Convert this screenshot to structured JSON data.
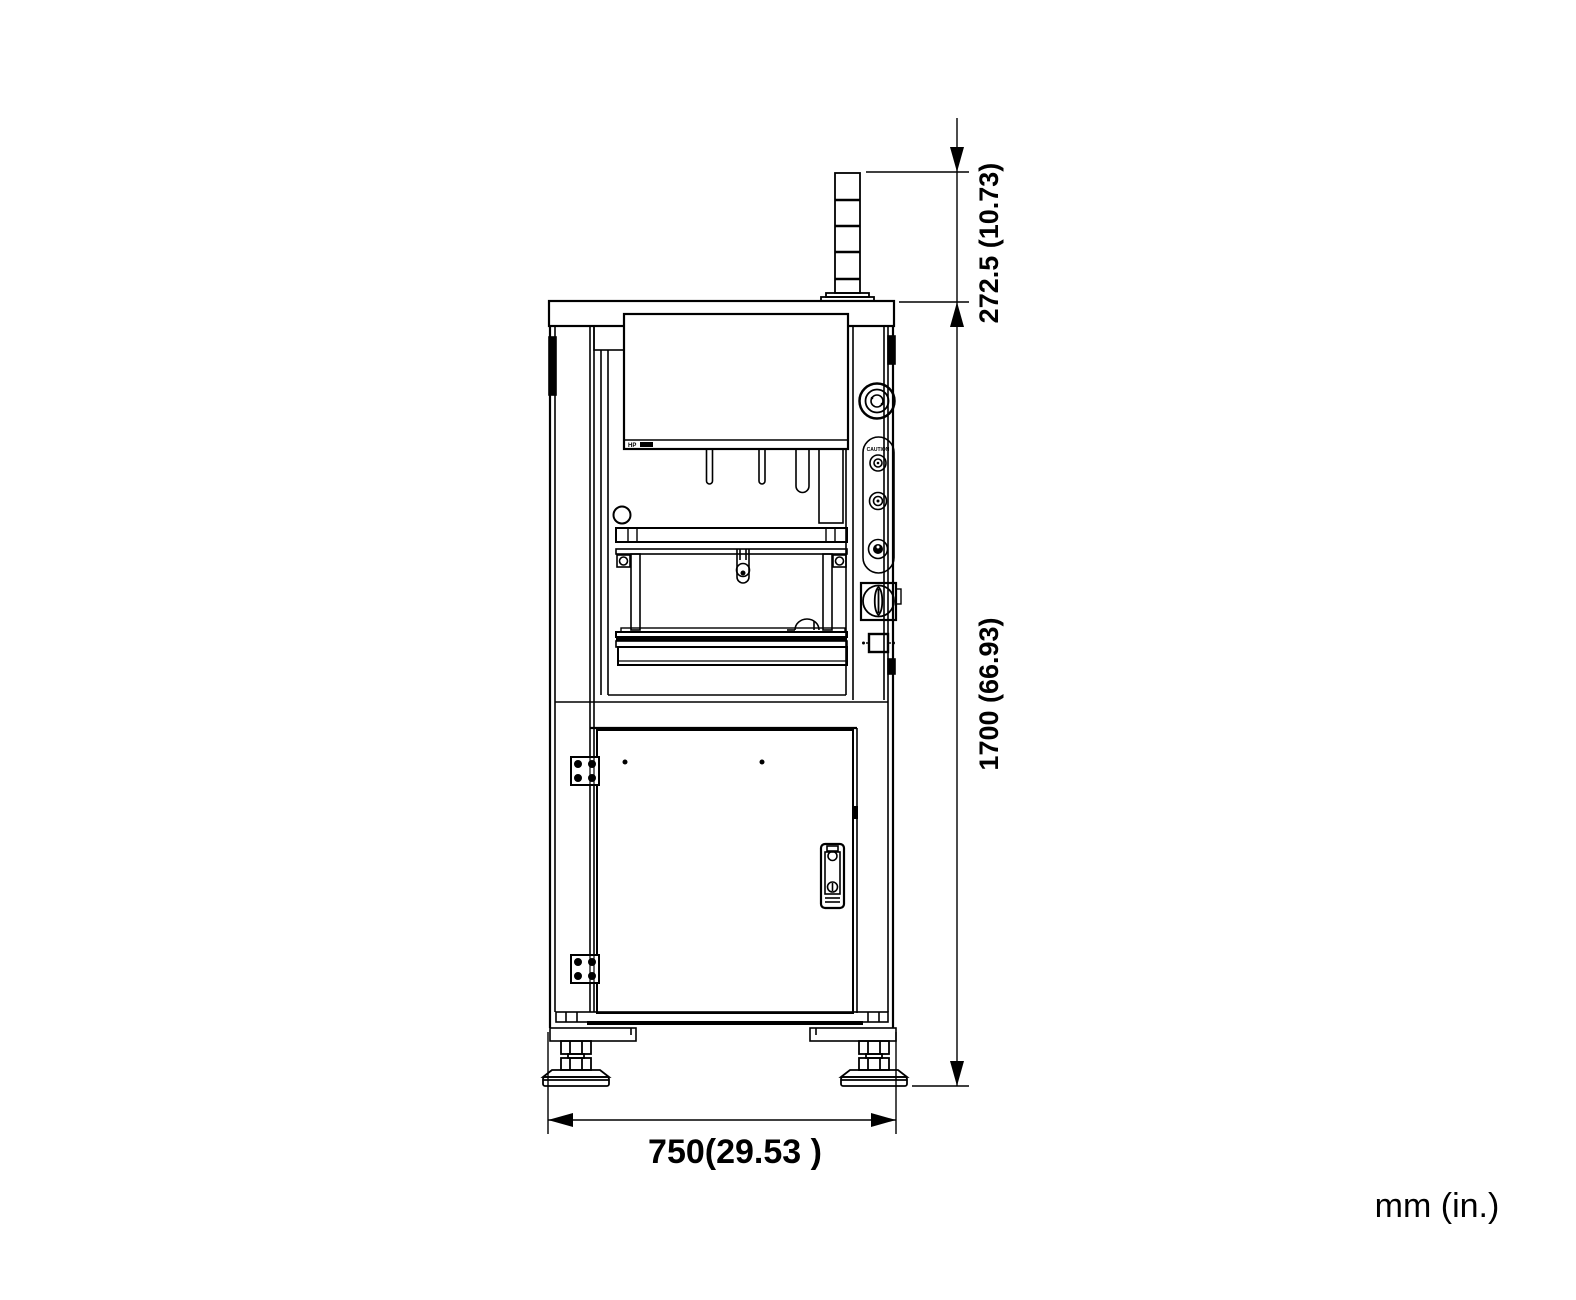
{
  "drawing": {
    "units_label": "mm (in.)",
    "dimensions": {
      "tower_height": {
        "mm": "272.5",
        "in": "10.73",
        "label": "272.5 (10.73)"
      },
      "machine_height": {
        "mm": "1700",
        "in": "66.93",
        "label": "1700 (66.93)"
      },
      "machine_width": {
        "mm": "750",
        "in": "29.53",
        "label": "750(29.53 )"
      }
    },
    "labels": {
      "machine_model": "HP",
      "control_panel": "CAUTION"
    },
    "colors": {
      "line": "#000000",
      "background": "#ffffff"
    }
  }
}
